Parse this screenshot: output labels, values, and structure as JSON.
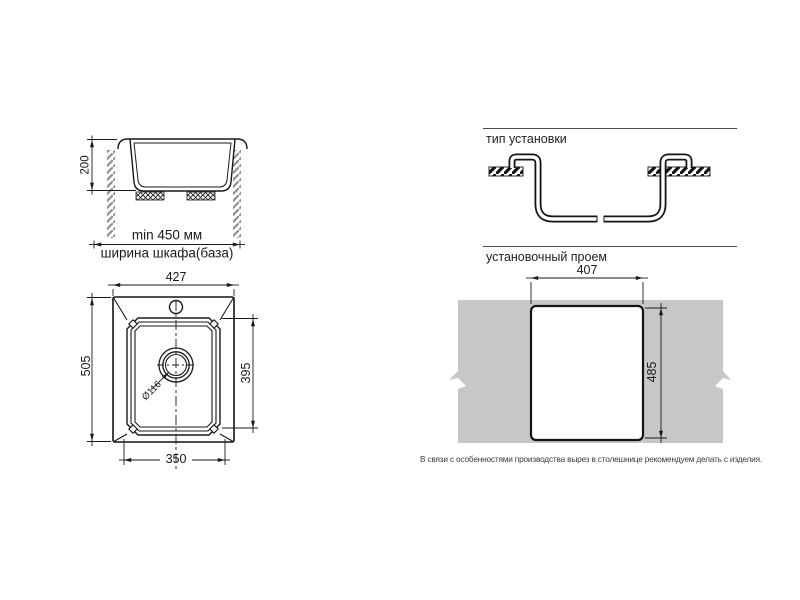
{
  "diagram": {
    "cabinet_section": {
      "depth": "200",
      "min_width": "min 450 мм",
      "cabinet_width": "ширина шкафа(база)"
    },
    "installation_type": {
      "title": "тип установки"
    },
    "top_view": {
      "overall_width": "427",
      "overall_depth": "505",
      "bowl_depth": "395",
      "bowl_width": "350",
      "drain_diameter": "Ø116"
    },
    "installation_opening": {
      "title": "установочный проем",
      "cutout_width": "407",
      "cutout_height": "485"
    },
    "note": "В связи с особенностями производства вырез в столешнице рекомендуем делать с изделия."
  },
  "colors": {
    "line": "#1a1a1a",
    "countertop": "#c7c7c7",
    "hatch_gray": "#8f8f8f"
  }
}
